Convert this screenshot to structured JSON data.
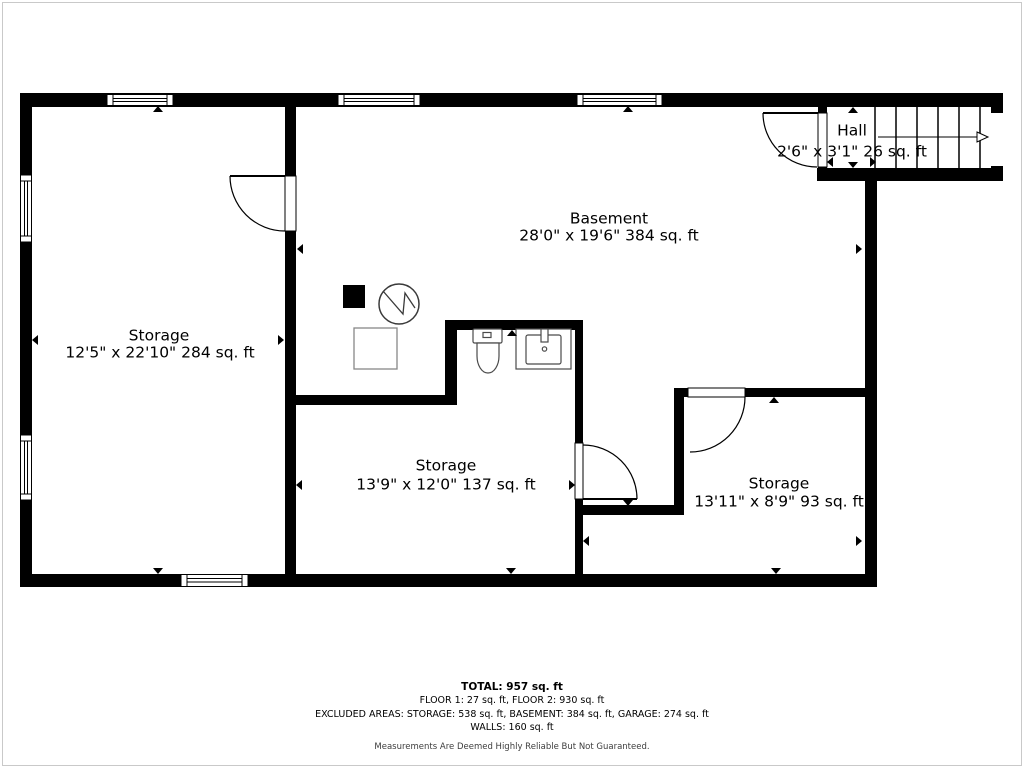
{
  "floorplan": {
    "rooms": [
      {
        "id": "storage-left",
        "name": "Storage",
        "dims": "12'5\" x 22'10\" 284 sq. ft"
      },
      {
        "id": "basement",
        "name": "Basement",
        "dims": "28'0\" x 19'6\" 384 sq. ft"
      },
      {
        "id": "hall",
        "name": "Hall",
        "dims": "2'6\" x 3'1\" 26 sq. ft"
      },
      {
        "id": "storage-middle",
        "name": "Storage",
        "dims": "13'9\" x 12'0\" 137 sq. ft"
      },
      {
        "id": "storage-right",
        "name": "Storage",
        "dims": "13'11\" x 8'9\" 93 sq. ft"
      }
    ],
    "fixtures": [
      "chimney-icon",
      "water-heater-icon",
      "appliance-icon",
      "toilet-icon",
      "sink-icon",
      "stairs-icon"
    ],
    "window_count": 6,
    "door_count": 4,
    "colors": {
      "wall": "#000000",
      "background": "#ffffff",
      "fixture_stroke": "#4a4a4a",
      "furniture_stroke": "#878787",
      "disclaimer_text": "#3d3d3d"
    }
  },
  "summary": {
    "total": "TOTAL: 957 sq. ft",
    "floors": "FLOOR 1: 27 sq. ft, FLOOR 2: 930 sq. ft",
    "excluded": "EXCLUDED AREAS: STORAGE: 538 sq. ft, BASEMENT: 384 sq. ft, GARAGE: 274 sq. ft",
    "walls": "WALLS: 160 sq. ft",
    "disclaimer": "Measurements Are Deemed Highly Reliable But Not Guaranteed."
  }
}
